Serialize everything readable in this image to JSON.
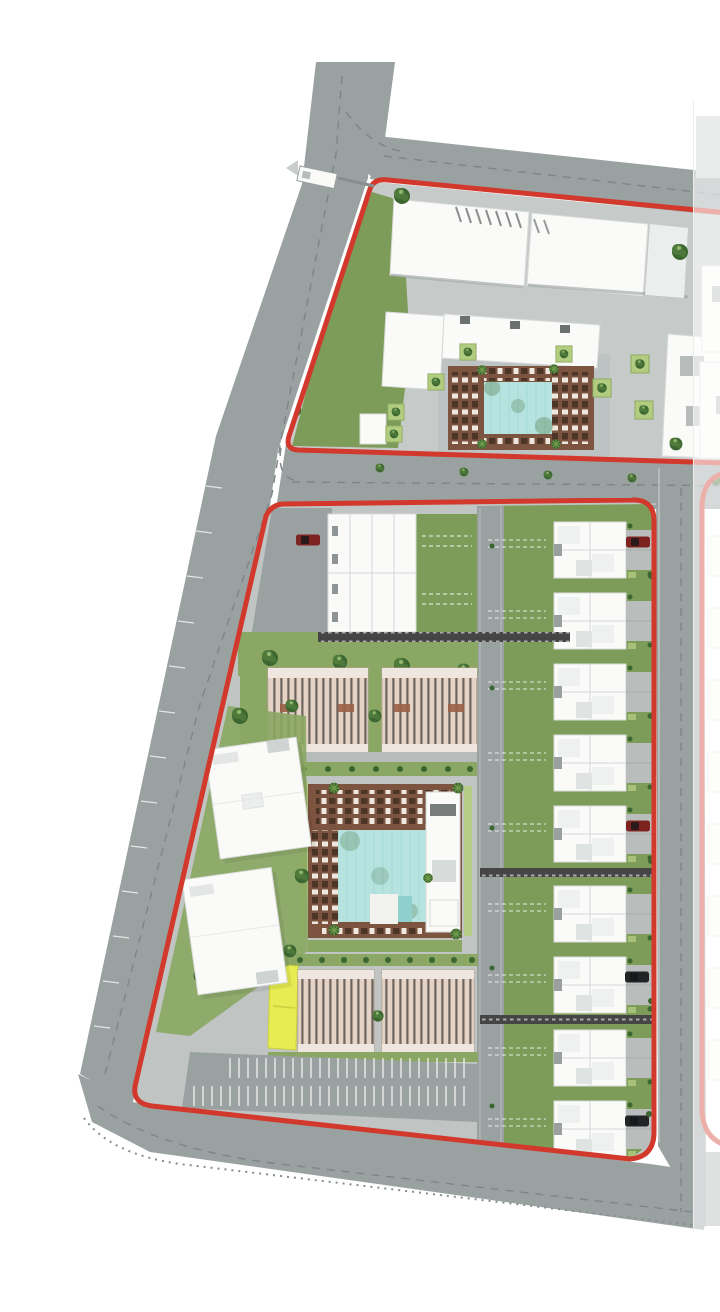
{
  "image": {
    "width": 720,
    "height": 1280,
    "description": "Aerial master-plan site rendering with red phase boundary lines, roads, residential blocks, two swimming-pool courtyards and a faded adjacent phase on the right"
  },
  "colors": {
    "background": "#ffffff",
    "road": "#9aa1a1",
    "sidewalk": "#c9cdcc",
    "plaza": "#b7bcbb",
    "parcel_top": "#c6cac9",
    "parcel_lower": "#c0c5c4",
    "lawn": "#8aa763",
    "green_field": "#7d9b59",
    "green_dark": "#4e7a3c",
    "green_darker": "#3c6630",
    "green_light": "#b2cc80",
    "pool": "#b6e3df",
    "pool_dark": "#8fd0cd",
    "deck": "#7d543f",
    "deck_slat": "#4a3527",
    "lounger": "#efe8de",
    "building_white": "#fafaf8",
    "building_stroke": "#d9dcda",
    "roof_tan": "#e4d6ca",
    "roof_bar": "#3f3d3a",
    "roof_brown": "#9b5f46",
    "boundary_red": "#d2382b",
    "yellow_highlight": "#e7ec52",
    "car_red": "#7e2420",
    "car_black": "#222426",
    "dash_grey": "#7e8586",
    "tick_white": "#f2f3f1",
    "pergola": "#454545",
    "overlay_white": "#ffffff"
  },
  "features": {
    "boundaries": [
      {
        "name": "phase-boundary-upper",
        "color": "boundary_red"
      },
      {
        "name": "phase-boundary-lower",
        "color": "boundary_red"
      },
      {
        "name": "adjacent-phase-boundary",
        "color": "boundary_red",
        "faded": true
      }
    ],
    "upper_parcel": {
      "retail_buildings": 3,
      "courtyard_pools": 1,
      "lounger_deck": true
    },
    "lower_parcel": {
      "townhouse_rows_right_column": 9,
      "townhouse_blocks_left_column": 1,
      "apartment_blocks": 4,
      "office_buildings": 2,
      "parking_rows": 2,
      "central_pool": 1,
      "pergola_walkways": 3,
      "parked_cars": 5,
      "highlighted_units": 1
    },
    "entrance_gate": true,
    "adjacent_phase_overlay": {
      "side": "right",
      "style": "semi-transparent white"
    }
  }
}
